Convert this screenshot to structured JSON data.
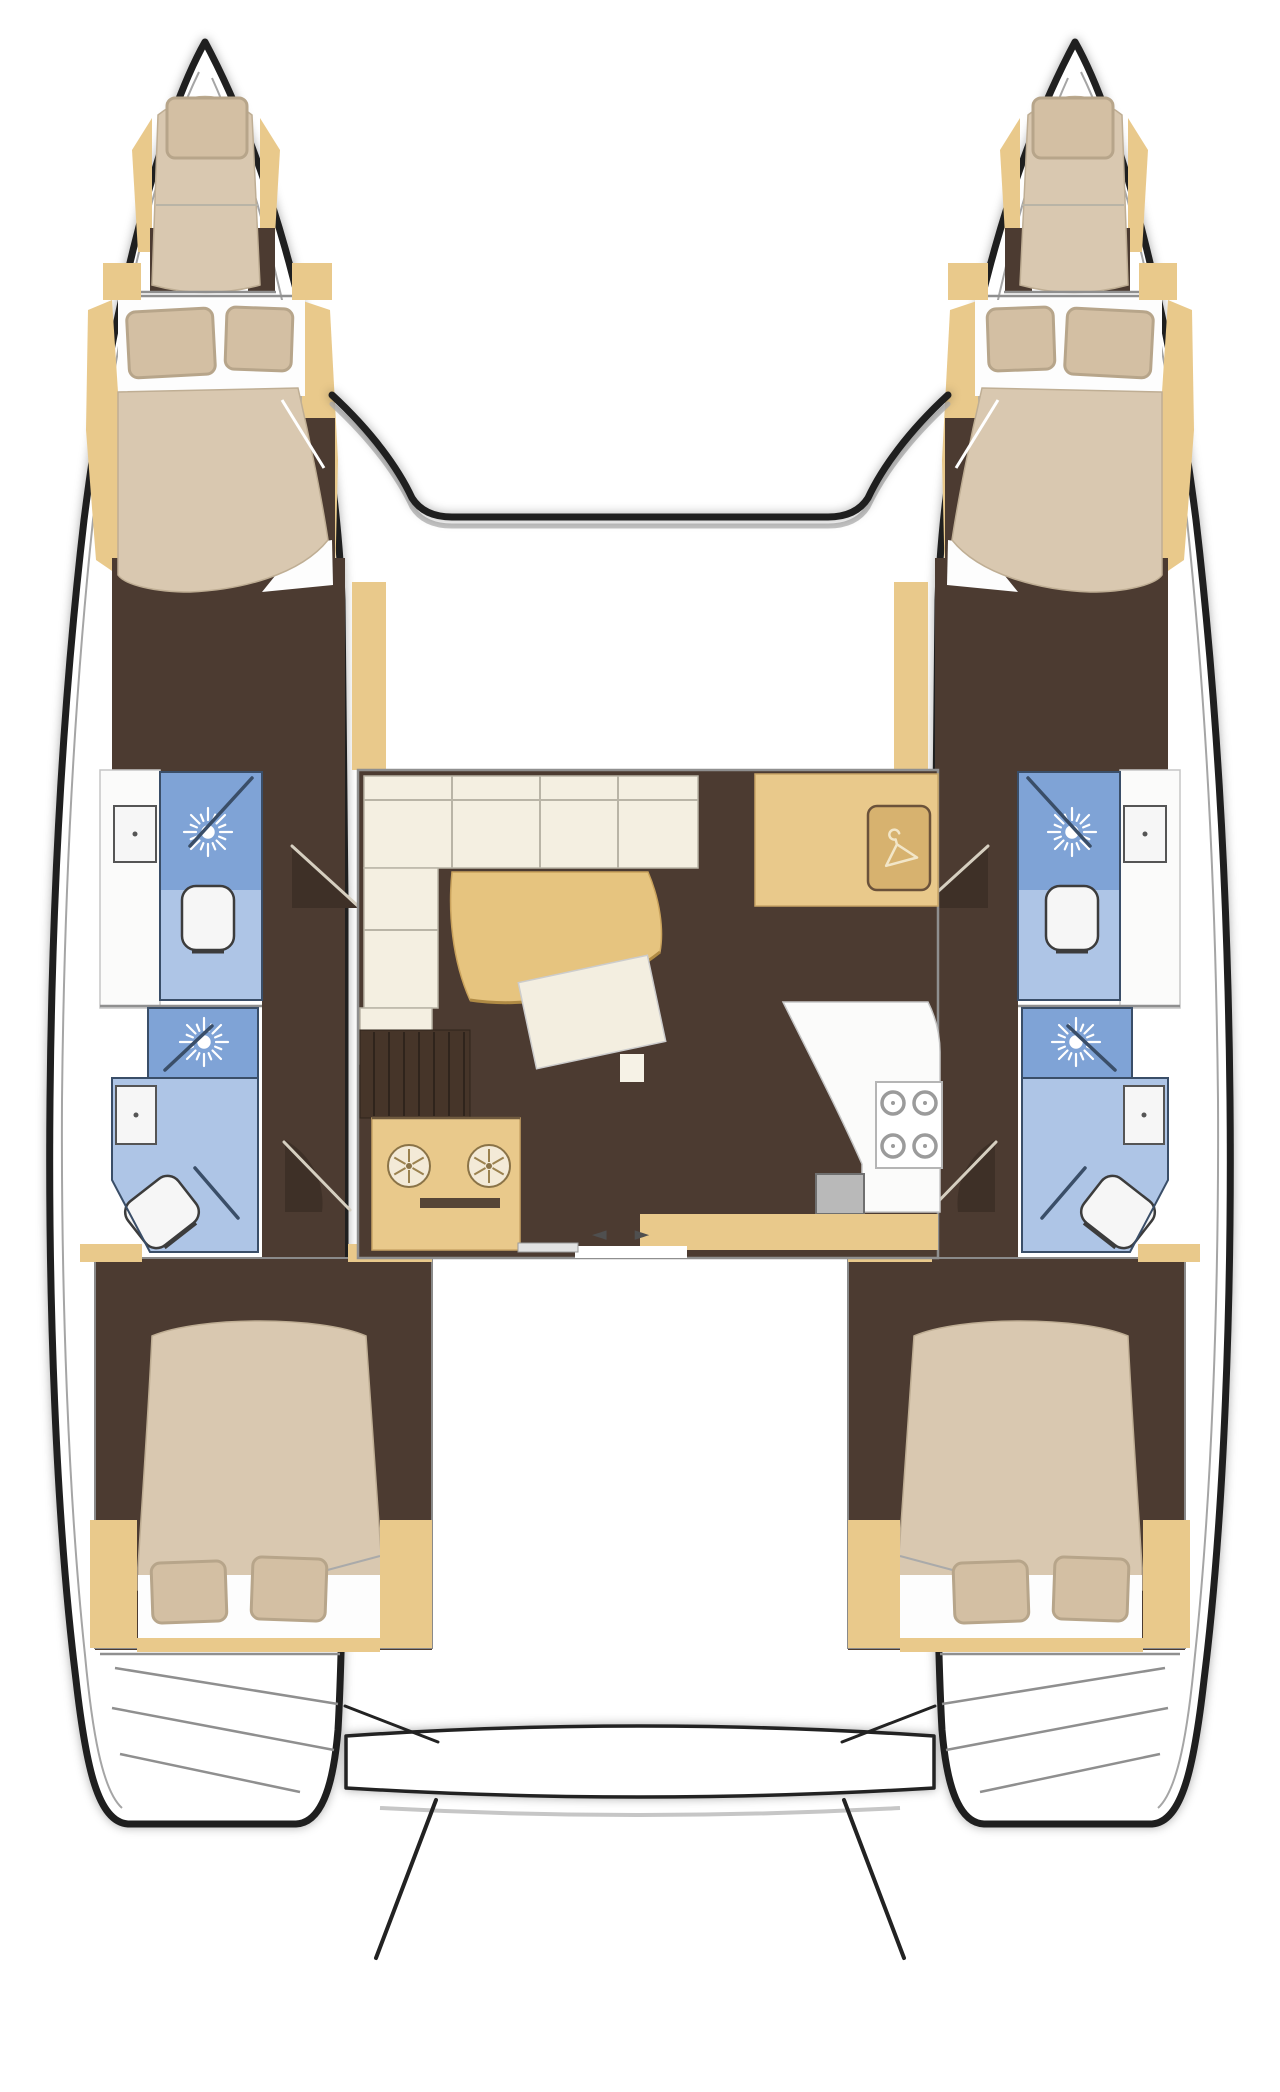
{
  "diagram": {
    "type": "boat-floorplan",
    "subject": "catamaran-interior-layout-top-view",
    "cabins_count": 4,
    "bathrooms_count": 4,
    "forepeak_berths_count": 2
  },
  "palette": {
    "outline": "#1f1f1f",
    "liner": "#a5a5a5",
    "wall_gray": "#8f8f8f",
    "wood": "#e9c98b",
    "wood_dark": "#c9a566",
    "floor_brown": "#4c3b31",
    "floor_brown_dark": "#3e3027",
    "bed_tan": "#d9c8b0",
    "pillow": "#d3bfa3",
    "pillow_edge": "#b7a58a",
    "sheet_white": "#fdfdfd",
    "sofa_cream": "#f4efe1",
    "sofa_line": "#b9b4a6",
    "bath_blue": "#aec5e6",
    "shower_blue": "#7fa3d6",
    "bath_line": "#3a4e68",
    "fixture_white": "#f6f6f6",
    "counter_white": "#fbfbfa",
    "stove_gray": "#9b9b9b",
    "sink_gray": "#b9b9b9",
    "table_tan": "#e6c47f",
    "door_arrow": "#4f4f4f"
  },
  "layout": {
    "hulls": [
      {
        "side": "port",
        "rooms": [
          "forepeak-berth",
          "forward-double-cabin",
          "forward-bathroom",
          "aft-bathroom",
          "aft-double-cabin",
          "transom-steps"
        ],
        "bathroom_fixtures": [
          "shower-rose",
          "toilet",
          "washbasin"
        ]
      },
      {
        "side": "starboard",
        "rooms": [
          "forepeak-berth",
          "forward-double-cabin",
          "forward-bathroom",
          "aft-bathroom",
          "aft-double-cabin",
          "transom-steps"
        ],
        "bathroom_fixtures": [
          "shower-rose",
          "toilet",
          "washbasin"
        ]
      }
    ],
    "saloon": {
      "features": [
        "l-shaped-sofa",
        "curved-dining-table",
        "tilted-coffee-table",
        "wardrobe-with-hanger",
        "galley-counter",
        "stove-4-burner",
        "twin-round-sinks",
        "galley-sink",
        "sliding-entry-door",
        "companionway-stairs-port",
        "companionway-stairs-starboard"
      ],
      "door_arrows": "◄ ►"
    },
    "cockpit": {
      "features": [
        "aft-bench",
        "boarding-platform-edges",
        "transom-steps-port",
        "transom-steps-starboard"
      ]
    }
  }
}
